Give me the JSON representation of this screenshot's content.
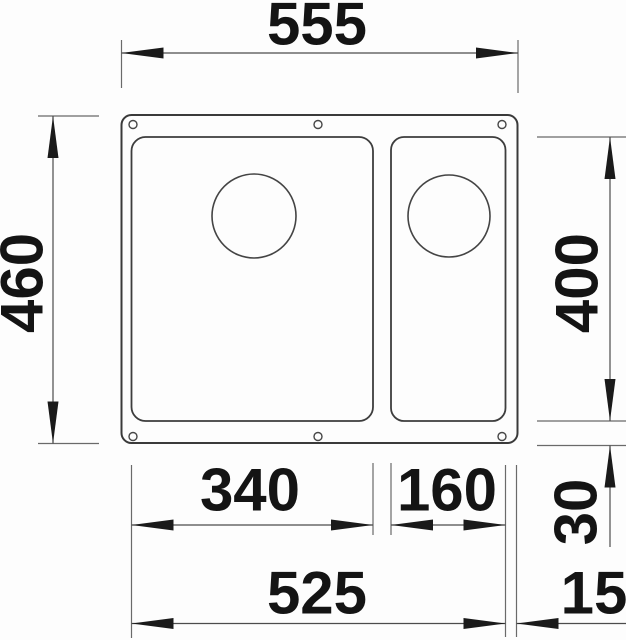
{
  "drawing": {
    "kind": "undermount-sink-installation-drawing",
    "unit": "mm",
    "dimensions": {
      "top_width": "555",
      "left_depth": "460",
      "right_bowl_depth": "400",
      "right_bottom_offset": "30",
      "main_bowl_width": "340",
      "small_bowl_width": "160",
      "bottom_inner_width": "525",
      "bottom_right_offset": "15"
    }
  }
}
